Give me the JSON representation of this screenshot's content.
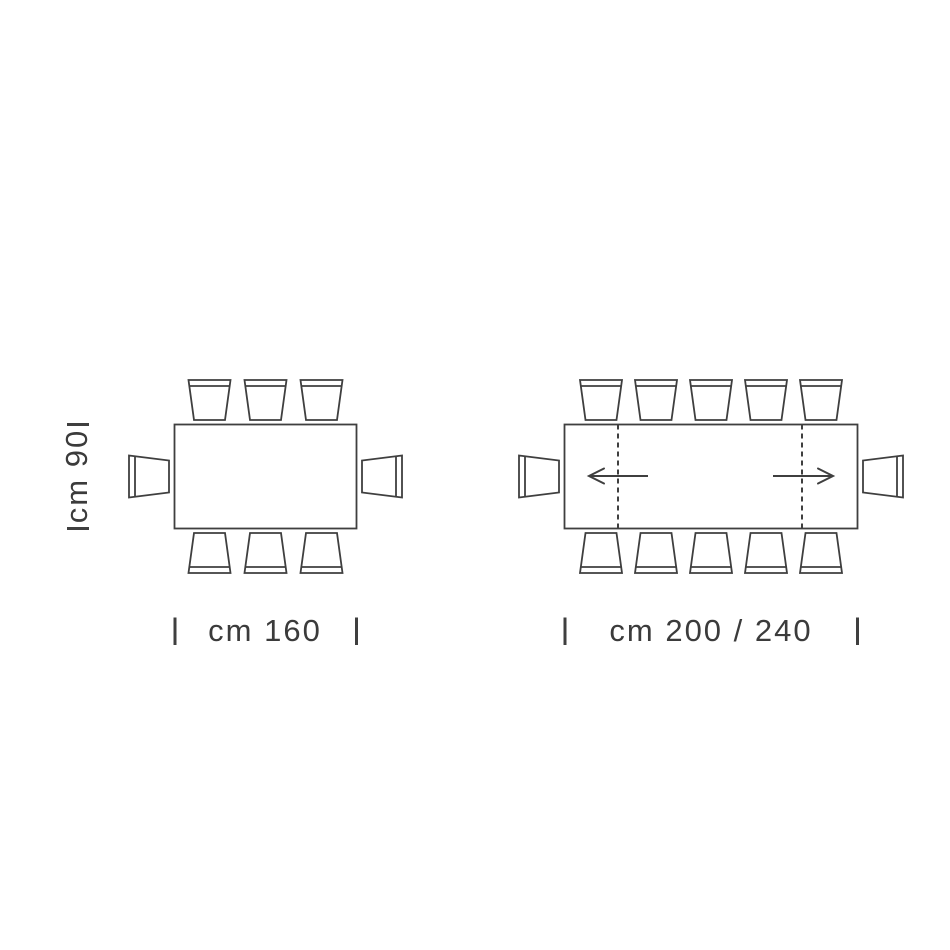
{
  "page": {
    "background": "#ffffff",
    "line_color": "#3f3f3f",
    "text_color": "#3b3b3b"
  },
  "dimensions": {
    "depth": {
      "label": "cm 90"
    }
  },
  "diagrams": [
    {
      "id": "table-160",
      "type": "fixed-rectangular-table-top-view",
      "width_label": "cm 160",
      "seats": {
        "top": 3,
        "bottom": 3,
        "left_end": 1,
        "right_end": 1,
        "total": 8
      },
      "extendable": false,
      "geometry": {
        "table": {
          "x": 174.5,
          "y": 424.5,
          "w": 182,
          "h": 104
        },
        "chair_pitch": 56,
        "width_ticks_x": [
          175,
          356.5
        ],
        "depth_ticks_y": [
          424.5,
          528.5
        ]
      }
    },
    {
      "id": "table-200-240",
      "type": "extendable-rectangular-table-top-view",
      "width_label": "cm 200 / 240",
      "seats": {
        "top": 5,
        "bottom": 5,
        "left_end": 1,
        "right_end": 1,
        "total": 12
      },
      "extendable": true,
      "extension": {
        "dashed_lines_x": [
          618,
          802
        ],
        "arrows": [
          {
            "tail_x": 648,
            "tip_x": 589,
            "y": 476,
            "direction": "left"
          },
          {
            "tail_x": 773,
            "tip_x": 833,
            "y": 476,
            "direction": "right"
          }
        ]
      },
      "geometry": {
        "table": {
          "x": 564.5,
          "y": 424.5,
          "w": 293,
          "h": 104
        },
        "chair_pitch": 55,
        "width_ticks_x": [
          565,
          857.5
        ]
      }
    }
  ],
  "chair_style": {
    "back_width": 42,
    "seat_front_width": 31,
    "depth": 40,
    "back_band_inset": 6,
    "end_chair_back_height": 42,
    "end_chair_front_height": 32,
    "gap_to_table": 4.5,
    "end_chair_back_offset": 45.5,
    "end_chair_front_offset": 5.5
  }
}
